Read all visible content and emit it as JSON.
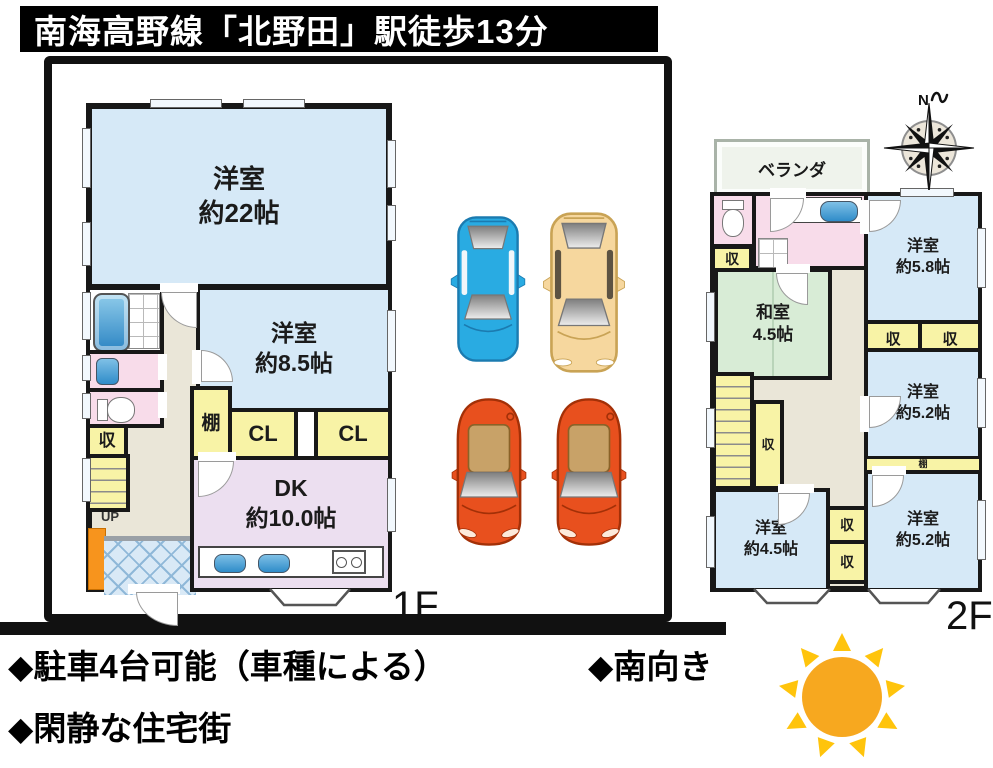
{
  "title": "南海高野線「北野田」駅徒歩13分",
  "labels": {
    "storage": "収",
    "closet": "CL",
    "shelf": "棚",
    "up": "UP",
    "north": "N"
  },
  "floor1": {
    "tag": "1F",
    "room22_name": "洋室",
    "room22_size": "約22帖",
    "room85_name": "洋室",
    "room85_size": "約8.5帖",
    "dk_name": "DK",
    "dk_size": "約10.0帖"
  },
  "floor2": {
    "tag": "2F",
    "veranda": "ベランダ",
    "washitsu_name": "和室",
    "washitsu_size": "4.5帖",
    "room58_name": "洋室",
    "room58_size": "約5.8帖",
    "room52a_name": "洋室",
    "room52a_size": "約5.2帖",
    "room45_name": "洋室",
    "room45_size": "約4.5帖",
    "room52b_name": "洋室",
    "room52b_size": "約5.2帖"
  },
  "footer": {
    "parking": "◆駐車4台可能（車種による）",
    "facing": "◆南向き",
    "quiet": "◆閑静な住宅街"
  },
  "colors": {
    "wall": "#181818",
    "room_blue": "#d6e9f7",
    "closet_yellow": "#f8f3a6",
    "dk_purple": "#ecdff0",
    "sanitary_pink": "#f8dcea",
    "tatami_green": "#d8ecd6",
    "hall_beige": "#eae6d8",
    "genkan_blue": "#d9e9f6",
    "accent_orange": "#f7941d",
    "car_blue": "#29abe2",
    "car_tan": "#f6d79e",
    "car_orange": "#e8501e",
    "sun_core": "#f7a81f",
    "sun_ray": "#ffc40c"
  }
}
